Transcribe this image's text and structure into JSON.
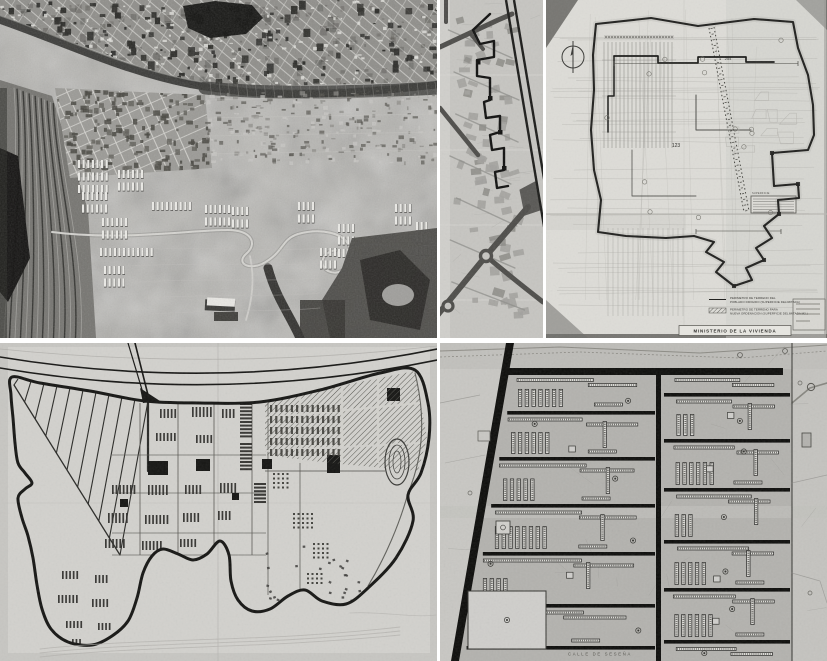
{
  "page": {
    "title": "Collage of historic aerial photograph and urban planning drawings",
    "background": "#ffffff"
  },
  "panels": {
    "aerial_photo": {
      "name": "aerial-photograph"
    },
    "district_map": {
      "name": "district-map-strip"
    },
    "site_plan": {
      "labels": {
        "dim_top": "254",
        "dim_mid": "123",
        "area_note": "SUPERFICIE"
      },
      "legend": {
        "item1_line1": "PERIMETRO DE TERRENO DEL",
        "item1_line2": "POBLADO DIRIGIDO (SUPERFICIE DELIMITADA)",
        "item2_line1": "PERIMETRO DE TERRENO PARA",
        "item2_line2": "NUEVA ORDENACION (SUPERFICIE DELIMITADA M2.)"
      },
      "title_block": "MINISTERIO DE LA VIVIENDA"
    },
    "master_plan": {
      "name": "master-plan-drawing"
    },
    "detail_plan": {
      "street_label": "CALLE DE SESEÑA"
    }
  },
  "palette": {
    "paper_light": "#dddcd7",
    "paper_mid": "#c7c6c2",
    "paper_dark": "#b3b2ae",
    "ink": "#161614",
    "ink_soft": "#44443f",
    "photo_base": "#b7b6b2",
    "photo_dark": "#3a3938",
    "photo_black": "#121210",
    "photo_light": "#ecebe7",
    "road_gray": "#4e4d4a",
    "building_gray": "#a3a29e"
  }
}
